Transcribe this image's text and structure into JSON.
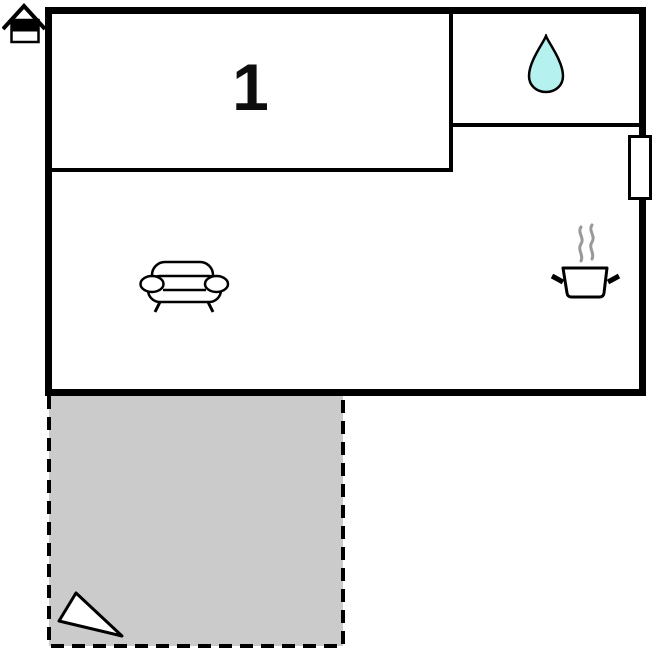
{
  "floorplan": {
    "title": "floor-plan",
    "rooms": {
      "bedroom": {
        "label": "1",
        "icon": ""
      },
      "bathroom": {
        "label": "",
        "icon": "water-droplet-icon"
      },
      "living_kitchen": {
        "label": "",
        "icons": [
          "sofa-icon",
          "cooking-pot-icon",
          "steam-icon"
        ]
      },
      "terrace": {
        "label": "",
        "icon": "direction-pointer-icon"
      }
    },
    "markers": {
      "entrance": "house-icon",
      "window": "window-marker"
    },
    "colors": {
      "wall": "#000000",
      "droplet_fill": "#b5f2ef",
      "steam": "#999999",
      "terrace_fill": "#cbcbcb",
      "icon_line": "#000000",
      "background": "#ffffff"
    }
  }
}
